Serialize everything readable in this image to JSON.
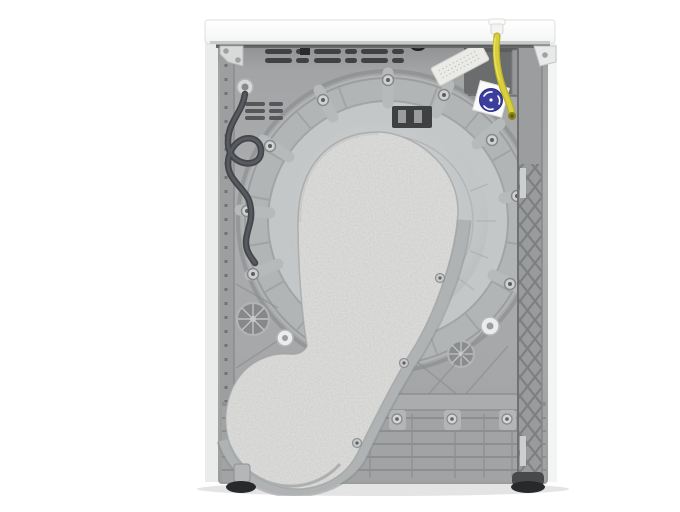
{
  "meta": {
    "description": "Rear view product photo of a white freestanding tumble dryer on a white background: grey moulded back panel with a large circular drum bulkhead, a pear-shaped grey felt insulation pad over the drum plus a round felt disc at lower left, coiled dark power cord hanging at upper left, yellow drain hose with white connector at upper right, dark capacitor box with a round blue specification sticker, cross-hatched side rail on the right, ribbed base plinth and dark feet.",
    "alt": "Back of a white tumble dryer showing grey rear panel, felt-covered drum, power cord and yellow hose"
  },
  "colors": {
    "bg": "#ffffff",
    "lid": "#fbfcfc",
    "lid_edge": "#d6d7d7",
    "gap_shadow": "#4a4c4e",
    "panel": "#a7a9aa",
    "panel_dark": "#8f9192",
    "drum_band": "#b3b6b7",
    "drum_dish": "#c7cacb",
    "felt": "#e0e0de",
    "felt_speckle": "#6b6b6a",
    "trim": "#b0b3b4",
    "cord": "#43454a",
    "hose": "#d8cf3e",
    "hose_dark": "#b9b028",
    "sticker_blue": "#3b3e9c",
    "sticker_card": "#fafaf9",
    "label_strip": "#eaeae7",
    "dark_box": "#6a6c6e",
    "lattice": "#999b9c",
    "lattice_line": "#7d7f81",
    "base": "#a1a3a4",
    "base_line": "#8a8c8d",
    "vent": "#3f4142",
    "screw": "#cfd1d2",
    "foot": "#28292a",
    "floor_shadow": "#e4e4e4"
  },
  "parts": [
    {
      "name": "worktop-lid"
    },
    {
      "name": "rear-panel"
    },
    {
      "name": "vent-slots"
    },
    {
      "name": "drum-bulkhead"
    },
    {
      "name": "felt-pad"
    },
    {
      "name": "felt-disc"
    },
    {
      "name": "power-cord"
    },
    {
      "name": "drain-hose"
    },
    {
      "name": "hose-connector"
    },
    {
      "name": "capacitor-box"
    },
    {
      "name": "rating-sticker"
    },
    {
      "name": "lattice-rail"
    },
    {
      "name": "base-plinth"
    },
    {
      "name": "feet"
    }
  ]
}
